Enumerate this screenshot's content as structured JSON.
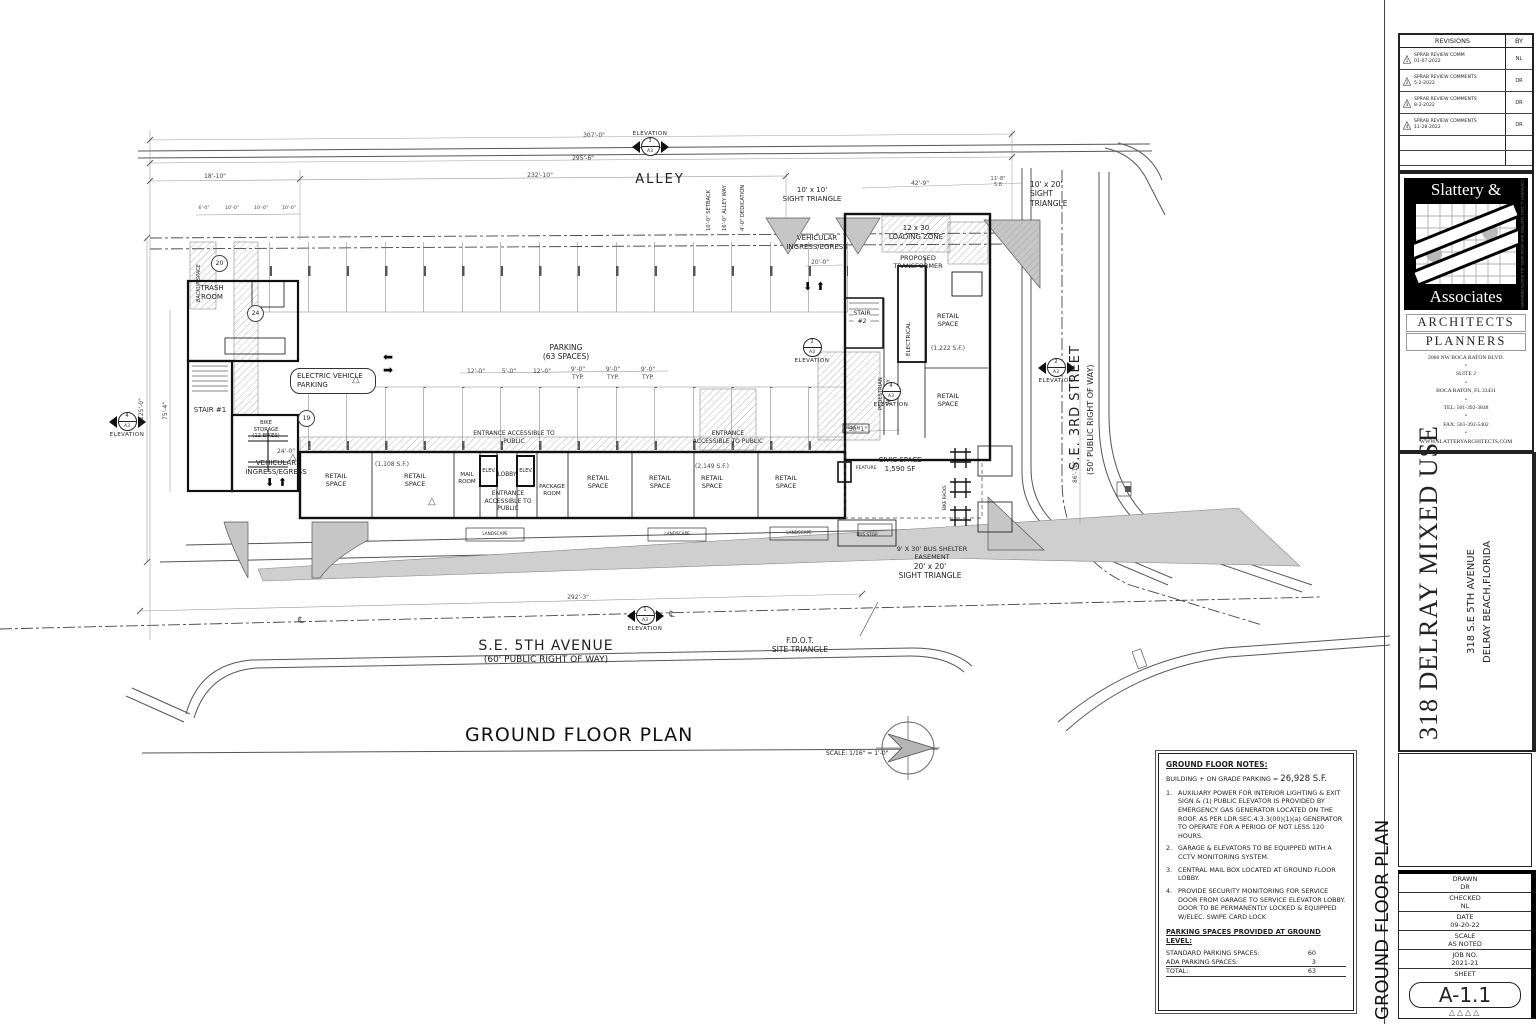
{
  "plan": {
    "title": {
      "text": "GROUND FLOOR PLAN",
      "scale": "SCALE: 1/16\" = 1'-0\""
    },
    "labels": {
      "alley": "ALLEY",
      "se5th_name": "S.E. 5TH AVENUE",
      "se5th_row": "(60' PUBLIC RIGHT OF WAY)",
      "se3rd_name": "S.E. 3RD STREET",
      "se3rd_row": "(50' PUBLIC RIGHT OF WAY)",
      "fdot1": "F.D.O.T.",
      "fdot2": "SITE TRIANGLE",
      "sight10a": "10' x 10'",
      "sight10b": "SIGHT TRIANGLE",
      "sight1020a": "10' x 20'",
      "sight1020b": "SIGHT",
      "sight1020c": "TRIANGLE",
      "sight2020a": "20' x 20'",
      "sight2020b": "SIGHT TRIANGLE",
      "loading1": "12 x 30",
      "loading2": "LOADING ZONE",
      "transformer1": "PROPOSED",
      "transformer2": "TRANSFORMER",
      "veh1": "VEHICULAR",
      "veh2": "INGRESS/EGRESS",
      "trash1": "TRASH",
      "trash2": "ROOM",
      "backup": "BACKUP SPACE",
      "stair1": "STAIR #1",
      "stair2a": "STAIR",
      "stair2b": "#2",
      "bike1": "BIKE",
      "bike2": "STORAGE",
      "bike3": "(12 BIKES)",
      "electrical": "ELECTRICAL",
      "ped1": "PEDESTRIAN",
      "ped2": "WALKWAY",
      "retail1": "RETAIL",
      "retail2": "SPACE",
      "sf1222": "(1,222 S.F.)",
      "sf1108": "(1,108 S.F.)",
      "sf2149": "(2,149 S.F.)",
      "civic1": "CIVIC SPACE",
      "civic2": "1,590 SF",
      "mail1": "MAIL",
      "mail2": "ROOM",
      "elev": "ELEV.",
      "lobby": "LOBBY",
      "package1": "PACKAGE",
      "package2": "ROOM",
      "entrance1": "ENTRANCE",
      "entrance2": "ACCESSIBLE TO",
      "entrance3": "PUBLIC",
      "parking1": "PARKING",
      "parking2": "(63 SPACES)",
      "ev1": "ELECTRIC VEHICLE",
      "ev2": "PARKING",
      "bench": "BENCH",
      "bus_stop": "BUS STOP",
      "shelter1": "9' X 30' BUS SHELTER",
      "shelter2": "EASEMENT",
      "bike_racks": "BIKE RACKS",
      "feature": "FEATURE",
      "landscape": "LANDSCAPE",
      "elevation": "ELEVATION",
      "setback": "10'-0\" SETBACK",
      "alleyway": "16'-0\" ALLEY WAY",
      "dedication": "4'-0\" DEDICATION",
      "centerline": "℄",
      "arrow_dd_uu": "⬇ ⬆",
      "arrow_left": "⬅",
      "arrow_right": "➡",
      "rev_tri": "△"
    },
    "dims": {
      "d307": "307'-0\"",
      "d295": "295'-6\"",
      "d232": "232'-10\"",
      "d18": "18'-10\"",
      "d42": "42'-9\"",
      "d11": "11'-8\"",
      "d5_8": "5.8",
      "d292": "292'-3\"",
      "d125": "125'-0\"",
      "d75": "75'-4\"",
      "d86": "86'-10\"",
      "d50": "50'-1\"",
      "d24": "24'-0\"",
      "d20": "20'-0\"",
      "d12": "12'-0\"",
      "d5": "5'-0\"",
      "d9": "9'-0\"",
      "typ": "TYP.",
      "d6": "6'-0\"",
      "d10": "10'-0\"",
      "d30": "30'-0\""
    },
    "markers": {
      "m1": {
        "no": "1",
        "sheet": "A3"
      },
      "m2": {
        "no": "2",
        "sheet": "A3"
      },
      "m3": {
        "no": "3",
        "sheet": "A3"
      },
      "m4": {
        "no": "4",
        "sheet": "A3"
      }
    },
    "stall_counts": {
      "c20": "20",
      "c24": "24",
      "c19": "19"
    }
  },
  "notes": {
    "heading": "GROUND FLOOR NOTES:",
    "building_pre": "BUILDING + ON GRADE PARKING = ",
    "building_sf": "26,928 S.F.",
    "items": [
      {
        "no": "1.",
        "text": "AUXILIARY POWER FOR INTERIOR LIGHTING & EXIT SIGN & (1) PUBLIC ELEVATOR IS PROVIDED BY EMERGENCY GAS GENERATOR LOCATED ON THE ROOF. AS PER LDR SEC.4.3.3(00)(1)(a) GENERATOR TO OPERATE FOR A PERIOD OF NOT LESS 120 HOURS."
      },
      {
        "no": "2.",
        "text": "GARAGE & ELEVATORS TO BE EQUIPPED WITH A CCTV MONITORING SYSTEM."
      },
      {
        "no": "3.",
        "text": "CENTRAL MAIL BOX LOCATED AT GROUND FLOOR LOBBY."
      },
      {
        "no": "4.",
        "text": "PROVIDE SECURITY MONITORING FOR SERVICE DOOR FROM GARAGE TO SERVICE ELEVATOR LOBBY. DOOR TO BE PERMANENTLY LOCKED & EQUIPPED W/ELEC. SWIPE CARD LOCK"
      }
    ],
    "parking_heading": "PARKING SPACES PROVIDED AT GROUND LEVEL:",
    "rows": [
      {
        "label": "STANDARD PARKING SPACES:",
        "value": "60"
      },
      {
        "label": "ADA PARKING SPACES:",
        "value": "3"
      },
      {
        "label": "TOTAL:",
        "value": "63"
      }
    ]
  },
  "titleblock": {
    "revisions": {
      "title": "REVISIONS",
      "by": "BY",
      "rows": [
        {
          "no": "1",
          "line1": "SPRAB REVIEW COMM",
          "line2": "01-07-2022",
          "by": "NL"
        },
        {
          "no": "2",
          "line1": "SPRAB REVIEW COMMENTS",
          "line2": "5-2-2022",
          "by": "DR"
        },
        {
          "no": "3",
          "line1": "SPRAB REVIEW COMMENTS",
          "line2": "8-2-2022",
          "by": "DR"
        },
        {
          "no": "4",
          "line1": "SPRAB REVIEW COMMENTS",
          "line2": "11-28-2022",
          "by": "DR"
        }
      ]
    },
    "firm": {
      "name1": "Slattery &",
      "name2": "Associates",
      "line1": "ARCHITECTS",
      "line2": "PLANNERS",
      "addr1": "2060 NW BOCA RATON BLVD.",
      "addr2": "SUITE 2",
      "addr3": "BOCA RATON,  FL 33431",
      "tel": "TEL: 561-392-3848",
      "fax": "FAX: 561-392-5402",
      "web": "WWW.SLATTERYARCHITECTS.COM",
      "bullet": "•",
      "copyright": "COPYRIGHT © 2021 SLATTERY AND ASSOCIATES. ALL RIGHTS RESERVED"
    },
    "project": {
      "name": "318 DELRAY MIXED USE",
      "addr": "318 S.E 5TH AVENUE",
      "city": "DELRAY BEACH,FLORIDA"
    },
    "info": {
      "side_title": "GROUND FLOOR PLAN",
      "drawn_label": "DRAWN",
      "drawn": "DR",
      "checked_label": "CHECKED",
      "checked": "NL",
      "date_label": "DATE",
      "date": "09-20-22",
      "scale_label": "SCALE",
      "scale": "AS NOTED",
      "job_label": "JOB NO.",
      "job": "2021-21",
      "sheet_label": "SHEET",
      "sheet": "A-1.1",
      "sheet_tris": "△△△△"
    }
  }
}
